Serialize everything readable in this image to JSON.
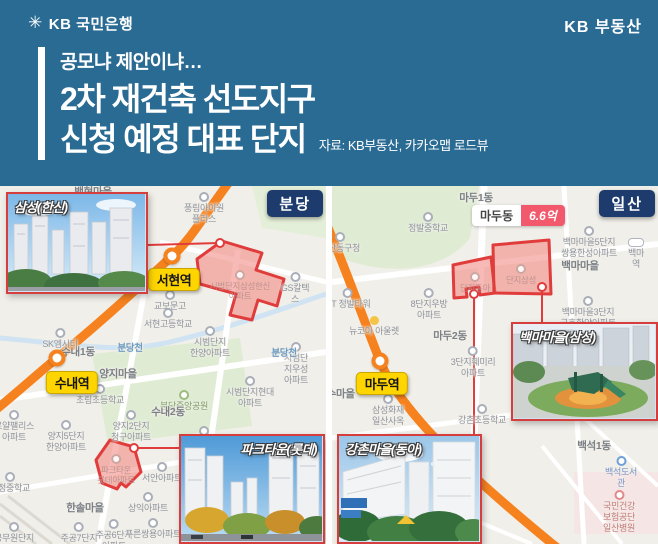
{
  "header": {
    "logo": "KB 국민은행",
    "brand": "KB 부동산",
    "logo_icon": "kb-star"
  },
  "title": {
    "eyebrow": "공모냐 제안이냐…",
    "line1": "2차 재건축 선도지구",
    "line2": "신청 예정 대표 단지",
    "source": "자료: KB부동산, 카카오맵 로드뷰"
  },
  "colors": {
    "header_bg": "#2a6b94",
    "region_badge_navy": "#1d3c6d",
    "station_yellow": "#ffd500",
    "zone_red": "#e03c3c",
    "rail_orange": "#f5821f",
    "price_red": "#f2596d",
    "map_bg": "#f1efe9",
    "park_green": "#dfecd3"
  },
  "maps": [
    {
      "region": "분당",
      "stations": [
        {
          "name": "서현역",
          "cx": 172,
          "cy": 70,
          "bx": 174,
          "by": 82
        },
        {
          "name": "수내역",
          "cx": 57,
          "cy": 172,
          "bx": 72,
          "by": 185
        }
      ],
      "photos": [
        {
          "label": "삼성(한신)"
        },
        {
          "label": "파크타운(롯데)"
        }
      ],
      "labels": [
        {
          "t": "백현마을",
          "x": 93,
          "y": 0,
          "c": "area"
        },
        {
          "t": "풍림아이원\n플러스",
          "x": 204,
          "y": 6,
          "c": "poi"
        },
        {
          "t": "GS칼텍스",
          "x": 295,
          "y": 86,
          "c": "poi"
        },
        {
          "t": "교보문고",
          "x": 170,
          "y": 104,
          "c": "poi"
        },
        {
          "t": "서현고등학교",
          "x": 168,
          "y": 122,
          "c": "school"
        },
        {
          "t": "시범단지\n한양아파트",
          "x": 210,
          "y": 140,
          "c": "poi"
        },
        {
          "t": "시범단지우성\n아파트",
          "x": 296,
          "y": 156,
          "c": "poi"
        },
        {
          "t": "시범단지삼성한신\n아파트",
          "x": 240,
          "y": 84,
          "c": "faded"
        },
        {
          "t": "수내1동",
          "x": 78,
          "y": 160,
          "c": "area"
        },
        {
          "t": "분당천",
          "x": 130,
          "y": 157,
          "c": "water"
        },
        {
          "t": "분당천",
          "x": 284,
          "y": 162,
          "c": "water"
        },
        {
          "t": "양지마을",
          "x": 118,
          "y": 182,
          "c": "area"
        },
        {
          "t": "초림초등학교",
          "x": 100,
          "y": 198,
          "c": "school"
        },
        {
          "t": "분당중앙공원",
          "x": 184,
          "y": 204,
          "c": "park"
        },
        {
          "t": "수내2동",
          "x": 168,
          "y": 220,
          "c": "area"
        },
        {
          "t": "시범단지현대\n아파트",
          "x": 250,
          "y": 190,
          "c": "poi"
        },
        {
          "t": "로얄팰리스\n아파트",
          "x": 14,
          "y": 224,
          "c": "poi"
        },
        {
          "t": "양지2단지\n청구아파트",
          "x": 131,
          "y": 224,
          "c": "poi"
        },
        {
          "t": "양지5단지\n한양아파트",
          "x": 66,
          "y": 234,
          "c": "poi"
        },
        {
          "t": "대림아파트",
          "x": 204,
          "y": 240,
          "c": "poi"
        },
        {
          "t": "서안아파트",
          "x": 162,
          "y": 276,
          "c": "poi"
        },
        {
          "t": "상익아파트",
          "x": 148,
          "y": 306,
          "c": "poi"
        },
        {
          "t": "내정중학교",
          "x": 10,
          "y": 286,
          "c": "school"
        },
        {
          "t": "한솔마을",
          "x": 85,
          "y": 316,
          "c": "area"
        },
        {
          "t": "주공7단지\n아파트",
          "x": 79,
          "y": 336,
          "c": "poi"
        },
        {
          "t": "주공6단지\n아파트",
          "x": 114,
          "y": 333,
          "c": "poi"
        },
        {
          "t": "푸른쌍용아파트",
          "x": 153,
          "y": 332,
          "c": "poi"
        },
        {
          "t": "공무원단지\n대림 등",
          "x": 14,
          "y": 336,
          "c": "poi"
        },
        {
          "t": "SK엠시티",
          "x": 60,
          "y": 142,
          "c": "poi"
        },
        {
          "t": "파크타운\n롯데아파트",
          "x": 116,
          "y": 268,
          "c": "faded"
        }
      ]
    },
    {
      "region": "일산",
      "price_badge": {
        "area": "마두동",
        "value": "6.6억"
      },
      "stations": [
        {
          "name": "마두역",
          "cx": 48,
          "cy": 175,
          "bx": 50,
          "by": 186
        }
      ],
      "photos": [
        {
          "label": "백마마을(삼성)"
        },
        {
          "label": "강촌마을(동아)"
        }
      ],
      "labels": [
        {
          "t": "마두1동",
          "x": 144,
          "y": 6,
          "c": "area"
        },
        {
          "t": "정발중학교",
          "x": 96,
          "y": 26,
          "c": "school"
        },
        {
          "t": "일산동구청",
          "x": 8,
          "y": 46,
          "c": "poi"
        },
        {
          "t": "백마마을5단지\n쌍용한성아파트",
          "x": 257,
          "y": 40,
          "c": "poi"
        },
        {
          "t": "백마역",
          "x": 304,
          "y": 52,
          "c": "subway"
        },
        {
          "t": "백마마을",
          "x": 248,
          "y": 74,
          "c": "area"
        },
        {
          "t": "8단지우방\n아파트",
          "x": 97,
          "y": 102,
          "c": "poi"
        },
        {
          "t": "KT 정발타워",
          "x": 16,
          "y": 102,
          "c": "poi"
        },
        {
          "t": "뉴코아 아울렛",
          "x": 42,
          "y": 130,
          "c": "shop"
        },
        {
          "t": "마두2동",
          "x": 118,
          "y": 144,
          "c": "area"
        },
        {
          "t": "백마마을3단지\n금호한양아파트",
          "x": 256,
          "y": 110,
          "c": "poi"
        },
        {
          "t": "3단지훼미리\n아파트",
          "x": 141,
          "y": 160,
          "c": "poi"
        },
        {
          "t": "장수마을",
          "x": 4,
          "y": 202,
          "c": "area"
        },
        {
          "t": "삼성화재\n일산사옥",
          "x": 56,
          "y": 208,
          "c": "poi"
        },
        {
          "t": "강촌초등학교",
          "x": 150,
          "y": 218,
          "c": "school"
        },
        {
          "t": "백석1동",
          "x": 262,
          "y": 254,
          "c": "area"
        },
        {
          "t": "백석도서관",
          "x": 289,
          "y": 270,
          "c": "lib"
        },
        {
          "t": "국민건강보험공단\n일산병원",
          "x": 287,
          "y": 304,
          "c": "hosp"
        },
        {
          "t": "단지동아",
          "x": 143,
          "y": 86,
          "c": "faded"
        },
        {
          "t": "단지삼성",
          "x": 189,
          "y": 78,
          "c": "faded"
        }
      ]
    }
  ]
}
